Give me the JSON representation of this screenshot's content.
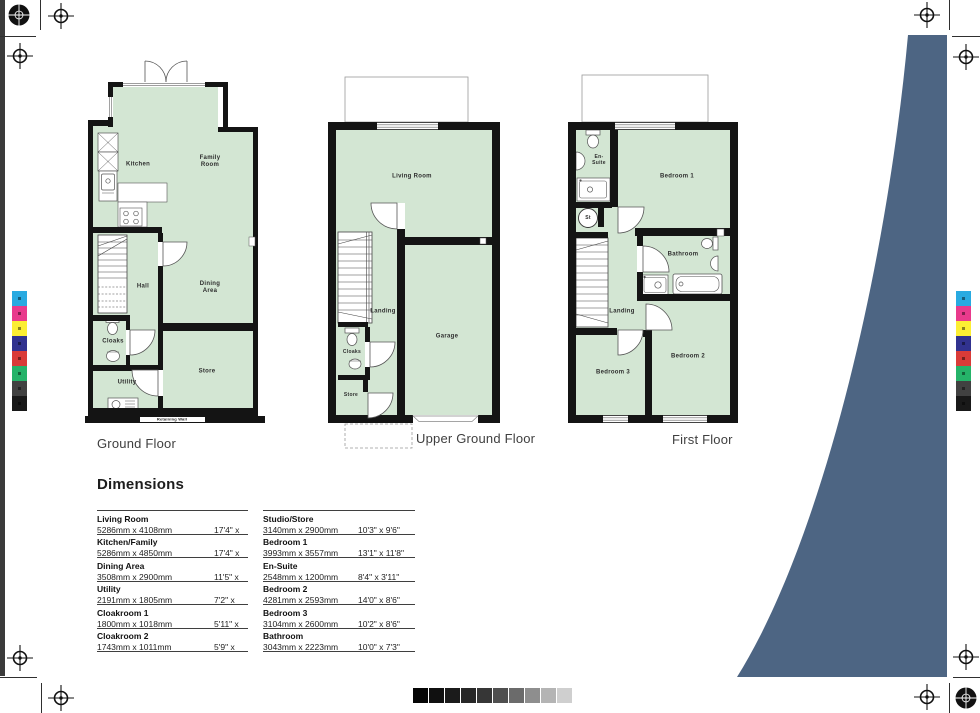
{
  "plans": {
    "ground": {
      "title": "Ground Floor",
      "rooms": {
        "kitchen": "Kitchen",
        "family": "Family Room",
        "hall": "Hall",
        "dining": "Dining Area",
        "cloaks": "Cloaks",
        "utility": "Utility",
        "store": "Store"
      },
      "retaining_wall": "Retaining Wall"
    },
    "upper": {
      "title": "Upper Ground Floor",
      "rooms": {
        "living": "Living Room",
        "landing": "Landing",
        "cloaks": "Cloaks",
        "store": "Store",
        "garage": "Garage"
      }
    },
    "first": {
      "title": "First Floor",
      "rooms": {
        "ensuite": "En-Suite",
        "st": "St",
        "bedroom1": "Bedroom 1",
        "bathroom": "Bathroom",
        "landing": "Landing",
        "bedroom3": "Bedroom 3",
        "bedroom2": "Bedroom 2"
      }
    }
  },
  "dimensions": {
    "heading": "Dimensions",
    "left": [
      {
        "name": "Living Room",
        "metric": "5286mm x 4108mm",
        "imperial": "17'4\" x 13'5\""
      },
      {
        "name": "Kitchen/Family",
        "metric": "5286mm x 4850mm",
        "imperial": "17'4\" x 15'11\""
      },
      {
        "name": "Dining Area",
        "metric": "3508mm x 2900mm",
        "imperial": "11'5\" x 9'6\""
      },
      {
        "name": "Utility",
        "metric": "2191mm x 1805mm",
        "imperial": "7'2\" x 5'11\""
      },
      {
        "name": "Cloakroom 1",
        "metric": "1800mm x 1018mm",
        "imperial": "5'11\" x 3'4\""
      },
      {
        "name": "Cloakroom 2",
        "metric": "1743mm x 1011mm",
        "imperial": "5'9\" x 3'4\""
      }
    ],
    "right": [
      {
        "name": "Studio/Store",
        "metric": "3140mm x 2900mm",
        "imperial": "10'3\" x 9'6\""
      },
      {
        "name": "Bedroom 1",
        "metric": "3993mm x 3557mm",
        "imperial": "13'1\" x 11'8\""
      },
      {
        "name": "En-Suite",
        "metric": "2548mm x 1200mm",
        "imperial": "8'4\" x 3'11\""
      },
      {
        "name": "Bedroom 2",
        "metric": "4281mm x 2593mm",
        "imperial": "14'0\" x 8'6\""
      },
      {
        "name": "Bedroom 3",
        "metric": "3104mm x 2600mm",
        "imperial": "10'2\" x 8'6\""
      },
      {
        "name": "Bathroom",
        "metric": "3043mm x 2223mm",
        "imperial": "10'0\" x 7'3\""
      }
    ]
  },
  "colors": {
    "room_fill": "#d3e6d3",
    "wall": "#141414",
    "swoosh": "#4d6583",
    "calibration": [
      "#29aae1",
      "#e93a8c",
      "#fcee33",
      "#31328f",
      "#d93b38",
      "#25b369",
      "#414141",
      "#191919"
    ],
    "grayscale": [
      "#050505",
      "#101010",
      "#1b1b1b",
      "#272727",
      "#363636",
      "#4f4f4f",
      "#6b6b6b",
      "#8e8e8e",
      "#b4b4b4",
      "#cfcfcf"
    ]
  }
}
